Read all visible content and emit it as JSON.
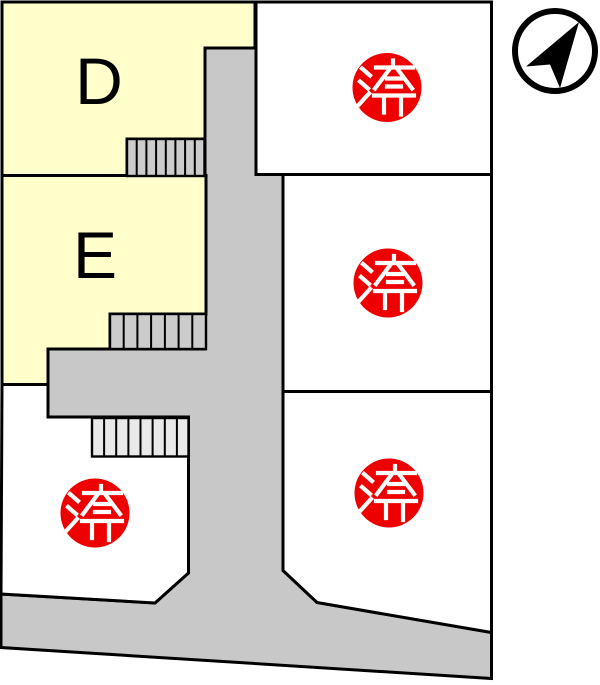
{
  "map": {
    "available_lots": [
      {
        "label": "D",
        "status": "available"
      },
      {
        "label": "E",
        "status": "available"
      }
    ],
    "sold_label": "済",
    "sold_lot_count": 4,
    "colors": {
      "available_fill": "#ffffcc",
      "road_fill": "#c8c8c8",
      "vacant_fill": "#ffffff",
      "sold_badge_fill": "#ee0000",
      "sold_text": "#ffffff",
      "outline": "#000000"
    },
    "compass_icon": "north-arrow-icon"
  }
}
